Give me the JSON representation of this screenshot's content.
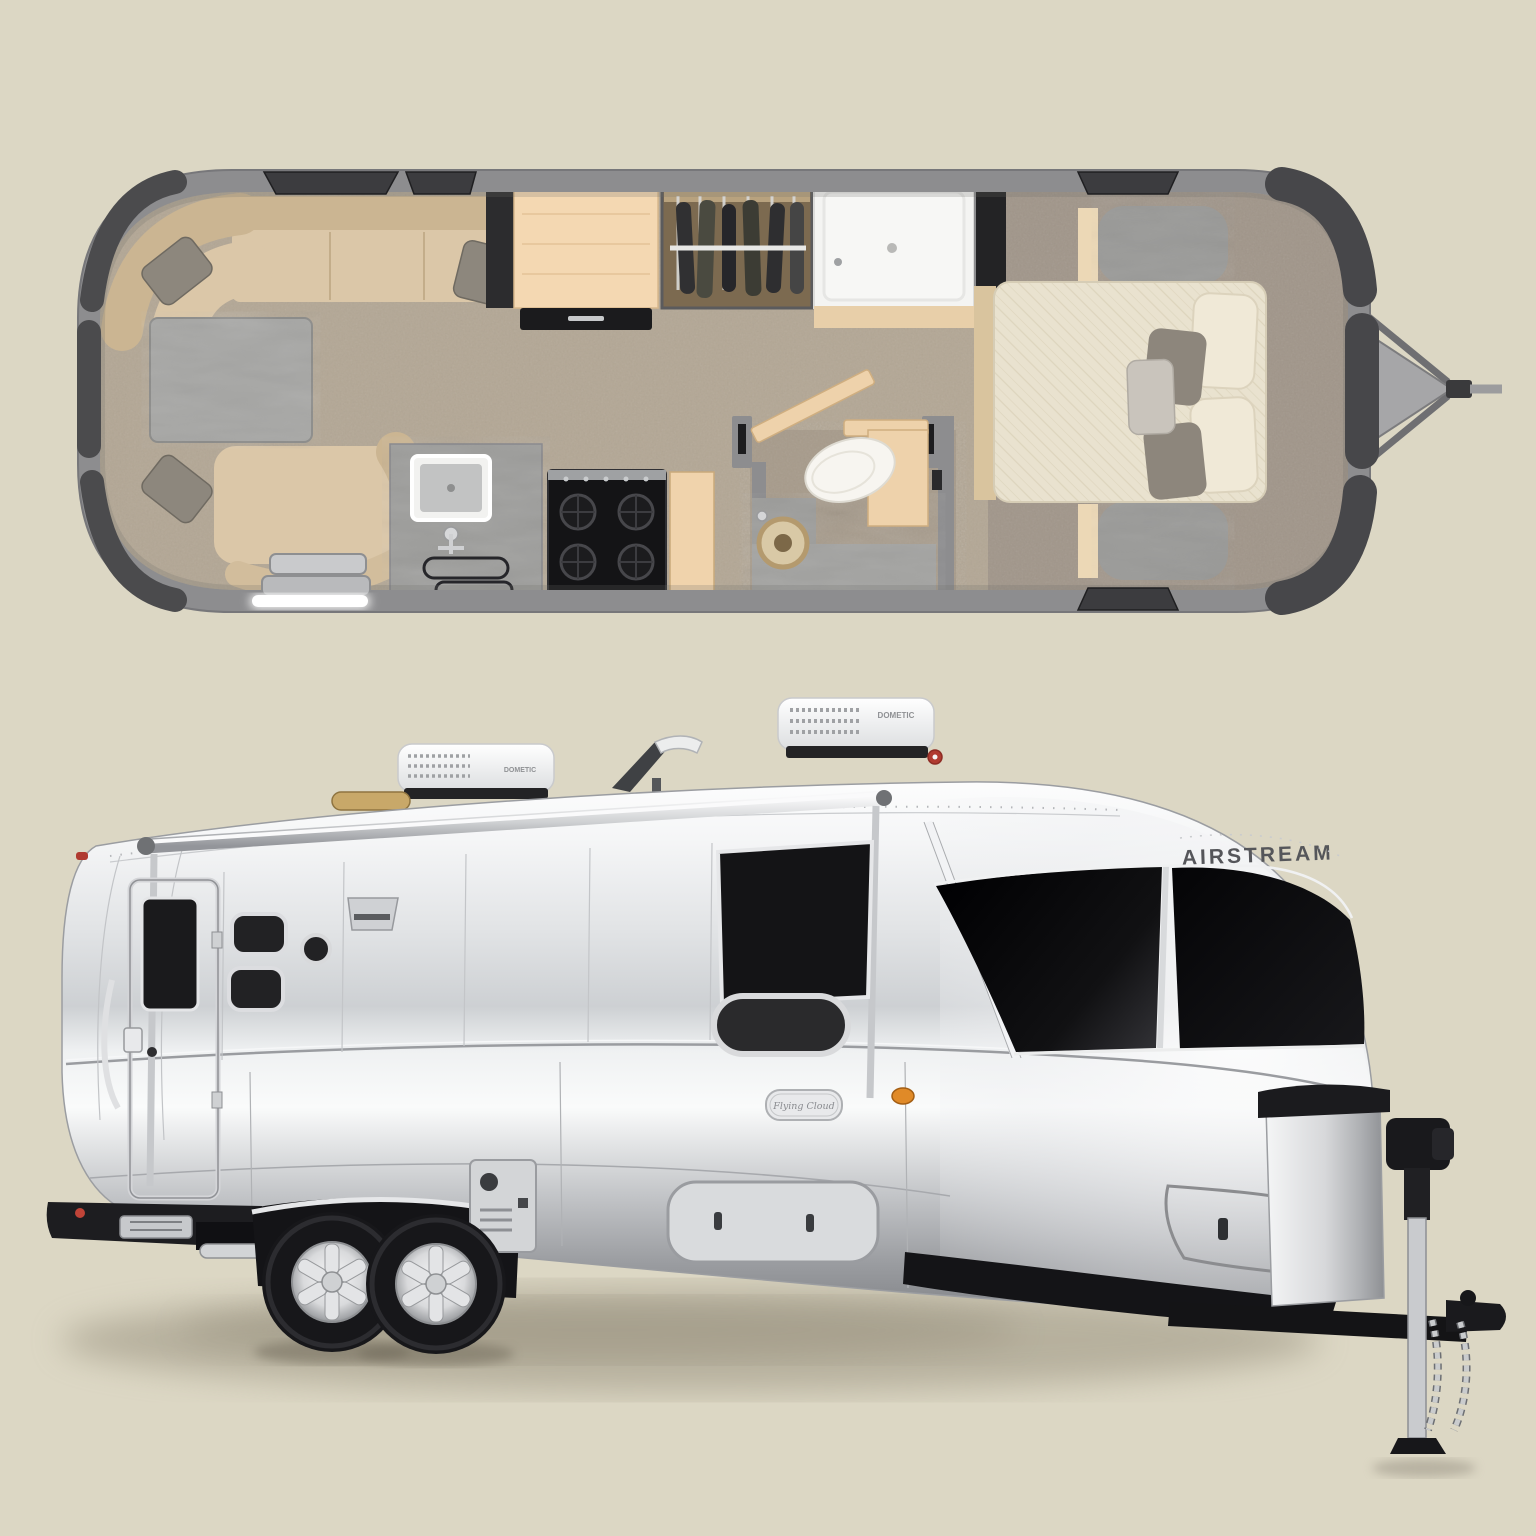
{
  "scene": {
    "background_color": "#dcd7c4",
    "subject": "Airstream Flying Cloud travel trailer: interior floor plan above, exterior three-quarter view below"
  },
  "floor_plan": {
    "colors": {
      "shell_wall": "#8d8d8f",
      "carpet": "#b3a795",
      "bedroom_carpet": "#a1968a",
      "upholstery": "#dbc7a8",
      "cabinet_wood": "#f4d8b2",
      "counter_marble": "#9d9d9b",
      "window_glass": "#4b4b4d"
    }
  },
  "trailer": {
    "brand": "AIRSTREAM",
    "model_badge": "Flying Cloud",
    "ac_front": {
      "brand": "DOMETIC"
    },
    "ac_rear": {
      "brand": "DOMETIC"
    },
    "colors": {
      "body_silver": "#dfe1e4",
      "window_glass": "#0d0d0f",
      "chassis_black": "#17171a",
      "marker_amber": "#e08a28",
      "marker_red": "#b03a30"
    }
  }
}
